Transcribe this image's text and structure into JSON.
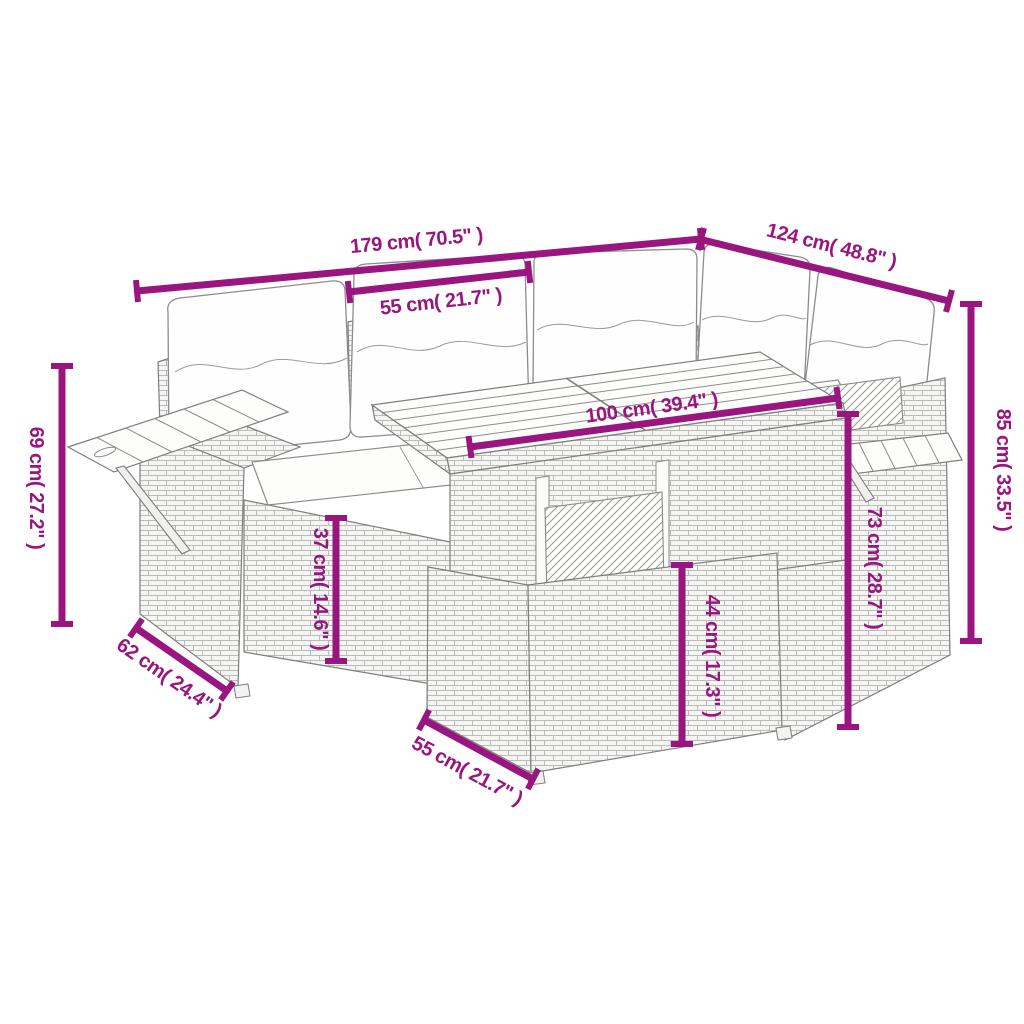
{
  "canvas": {
    "background": "#FFFFFF",
    "accent": "#99157F",
    "furniture_outline": "#7E7E7E",
    "wicker_line": "#BBBBBA",
    "cushion_fill": "#FEFEFE"
  },
  "dimensions": [
    {
      "id": "total-width",
      "label": "179 cm( 70.5\" )"
    },
    {
      "id": "total-depth-right",
      "label": "124 cm( 48.8\" )"
    },
    {
      "id": "seat-width",
      "label": "55 cm( 21.7\" )"
    },
    {
      "id": "table-length",
      "label": "100 cm( 39.4\" )"
    },
    {
      "id": "armrest-height",
      "label": "69 cm( 27.2\" )"
    },
    {
      "id": "seat-height",
      "label": "37 cm( 14.6\" )"
    },
    {
      "id": "stool-height",
      "label": "44 cm( 17.3\" )"
    },
    {
      "id": "table-height",
      "label": "73 cm( 28.7\" )"
    },
    {
      "id": "backrest-height",
      "label": "85 cm( 33.5\" )"
    },
    {
      "id": "seat-depth",
      "label": "62 cm( 24.4\" )"
    },
    {
      "id": "stool-depth",
      "label": "55 cm( 21.7\" )"
    }
  ]
}
